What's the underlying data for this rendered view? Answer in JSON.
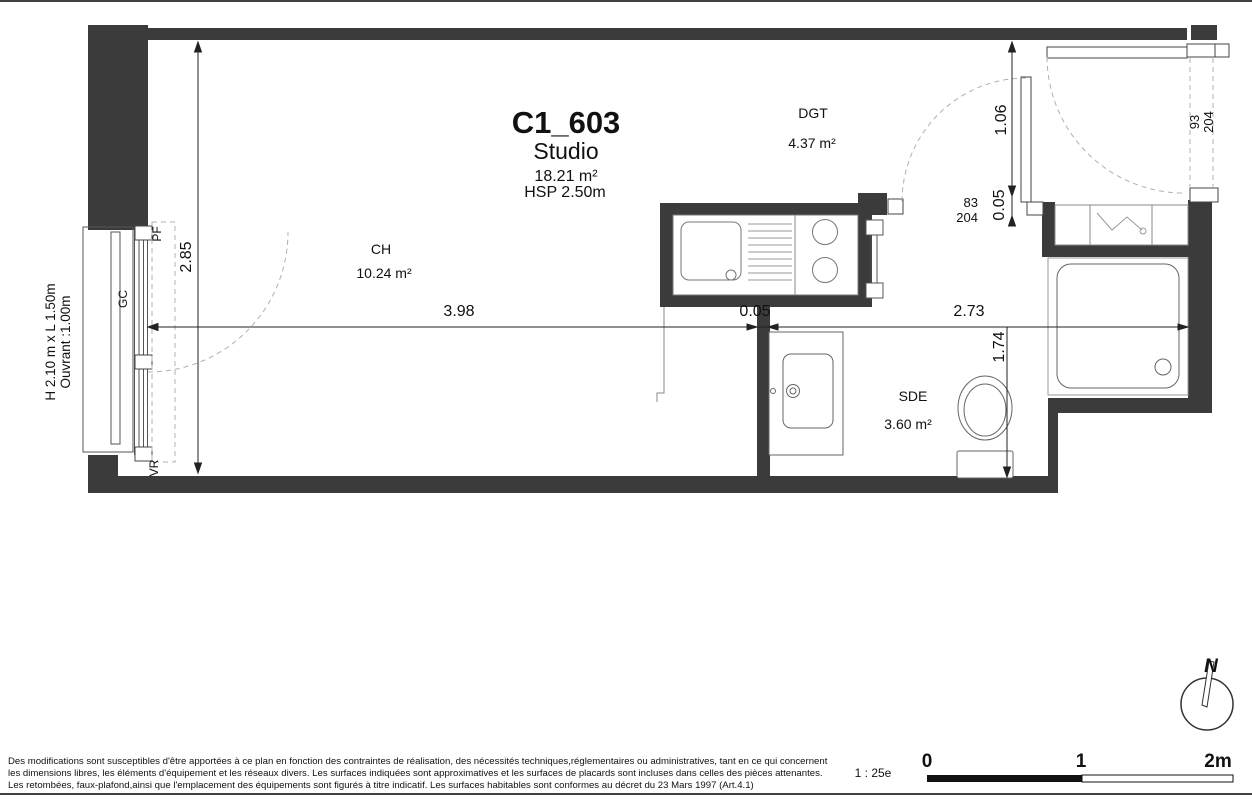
{
  "title": {
    "unit": "C1_603",
    "type": "Studio",
    "area": "18.21 m²",
    "hsp": "HSP 2.50m"
  },
  "rooms": {
    "ch": {
      "name": "CH",
      "area": "10.24 m²"
    },
    "dgt": {
      "name": "DGT",
      "area": "4.37 m²"
    },
    "sde": {
      "name": "SDE",
      "area": "3.60 m²"
    }
  },
  "dims": {
    "width": "2.85",
    "ch_len": "3.98",
    "part": "0.05",
    "sde_len": "2.73",
    "entry": "1.06",
    "entry_gap": "0.05",
    "sde_depth": "1.74"
  },
  "doors": {
    "sde": {
      "w": "83",
      "h": "204"
    },
    "entrance": {
      "w": "93",
      "h": "204"
    }
  },
  "window": {
    "line1": "H 2.10 m x L 1.50m",
    "line2": "Ouvrant :1.00m",
    "gc": "GC",
    "pf": "PF",
    "vr": "VR"
  },
  "compass": {
    "n": "N"
  },
  "scalebar": {
    "ratio": "1 : 25e",
    "t0": "0",
    "t1": "1",
    "t2": "2m"
  },
  "disclaimer": {
    "l1": "Des modifications sont susceptibles d'être apportées à ce plan en fonction des contraintes de réalisation, des nécessités techniques,réglementaires ou administratives, tant en ce qui concernent",
    "l2": "les dimensions libres, les éléments d'équipement et les réseaux divers. Les surfaces indiquées sont approximatives et les surfaces de placards sont incluses dans celles des pièces attenantes.",
    "l3": "Les retombées, faux-plafond,ainsi que l'emplacement des équipements sont figurés à titre indicatif. Les surfaces habitables sont conformes au décret du 23 Mars 1997 (Art.4.1)"
  },
  "colors": {
    "wall": "#3b3b3b",
    "line": "#555555",
    "dash": "#b0b0b0"
  }
}
